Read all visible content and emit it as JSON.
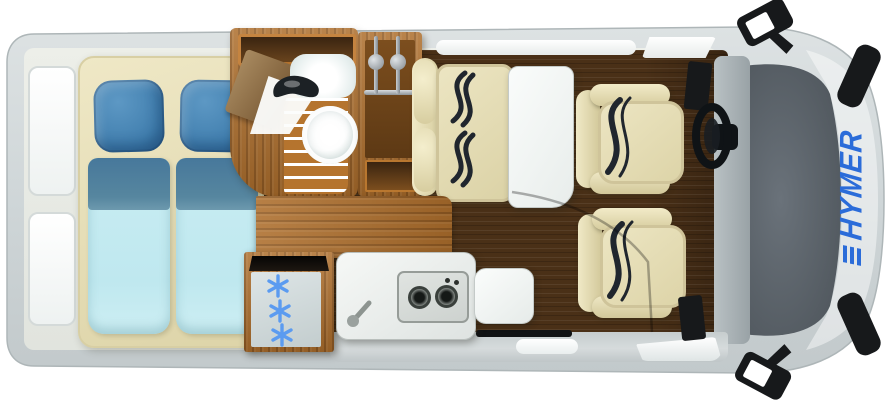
{
  "title": "HYMER camper van floor plan (top view)",
  "brand": {
    "logo_text": "HYMER",
    "logo_mark": "three-bar emblem",
    "logo_orientation": "rotated 90° on hood"
  },
  "vehicle": {
    "view": "top-down floor plan",
    "rear_windows": 2,
    "side_mirrors": 2
  },
  "areas": {
    "bedroom": {
      "type": "rear transverse double bed",
      "pillows": 2,
      "duvets": 2
    },
    "bathroom": {
      "fixtures": [
        "sink",
        "black-faucet",
        "toilet",
        "wood-slat-shower-floor",
        "top-shelf",
        "angled-door"
      ]
    },
    "wardrobe": {
      "hangers": 2,
      "rail": 1,
      "lower_shelf": 1
    },
    "dinette": {
      "fixtures": [
        "two-point-belt-bench",
        "white-table",
        "wall-shelf"
      ]
    },
    "kitchen": {
      "burners": 2,
      "knobs": 2,
      "fixtures": [
        "sink-faucet",
        "two-burner-hob",
        "worktop-extension"
      ]
    },
    "fridge": {
      "snowflake_icons": 3
    },
    "cab": {
      "swivel_seats": 2,
      "fixtures": [
        "steering-wheel",
        "windshield",
        "dashboard"
      ]
    }
  },
  "colors": {
    "body_gray": "#cdd4d6",
    "body_edge": "#aeb6b8",
    "interior_pale": "#e9ece6",
    "floor_dark": "#4a3017",
    "furniture_wood": "#b5722e",
    "mattress_cream": "#e9e2bd",
    "pillow_blue": "#4383b4",
    "duvet_band_blue": "#4d7da0",
    "duvet_cyan": "#c9edf3",
    "counter_white": "#eef1ef",
    "windshield_gray": "#565e66",
    "seatbelt_dark": "#20262e",
    "snowflake_blue": "#5b9bf0",
    "hymer_blue": "#2b6cd9",
    "mirror_black": "#17191b"
  }
}
